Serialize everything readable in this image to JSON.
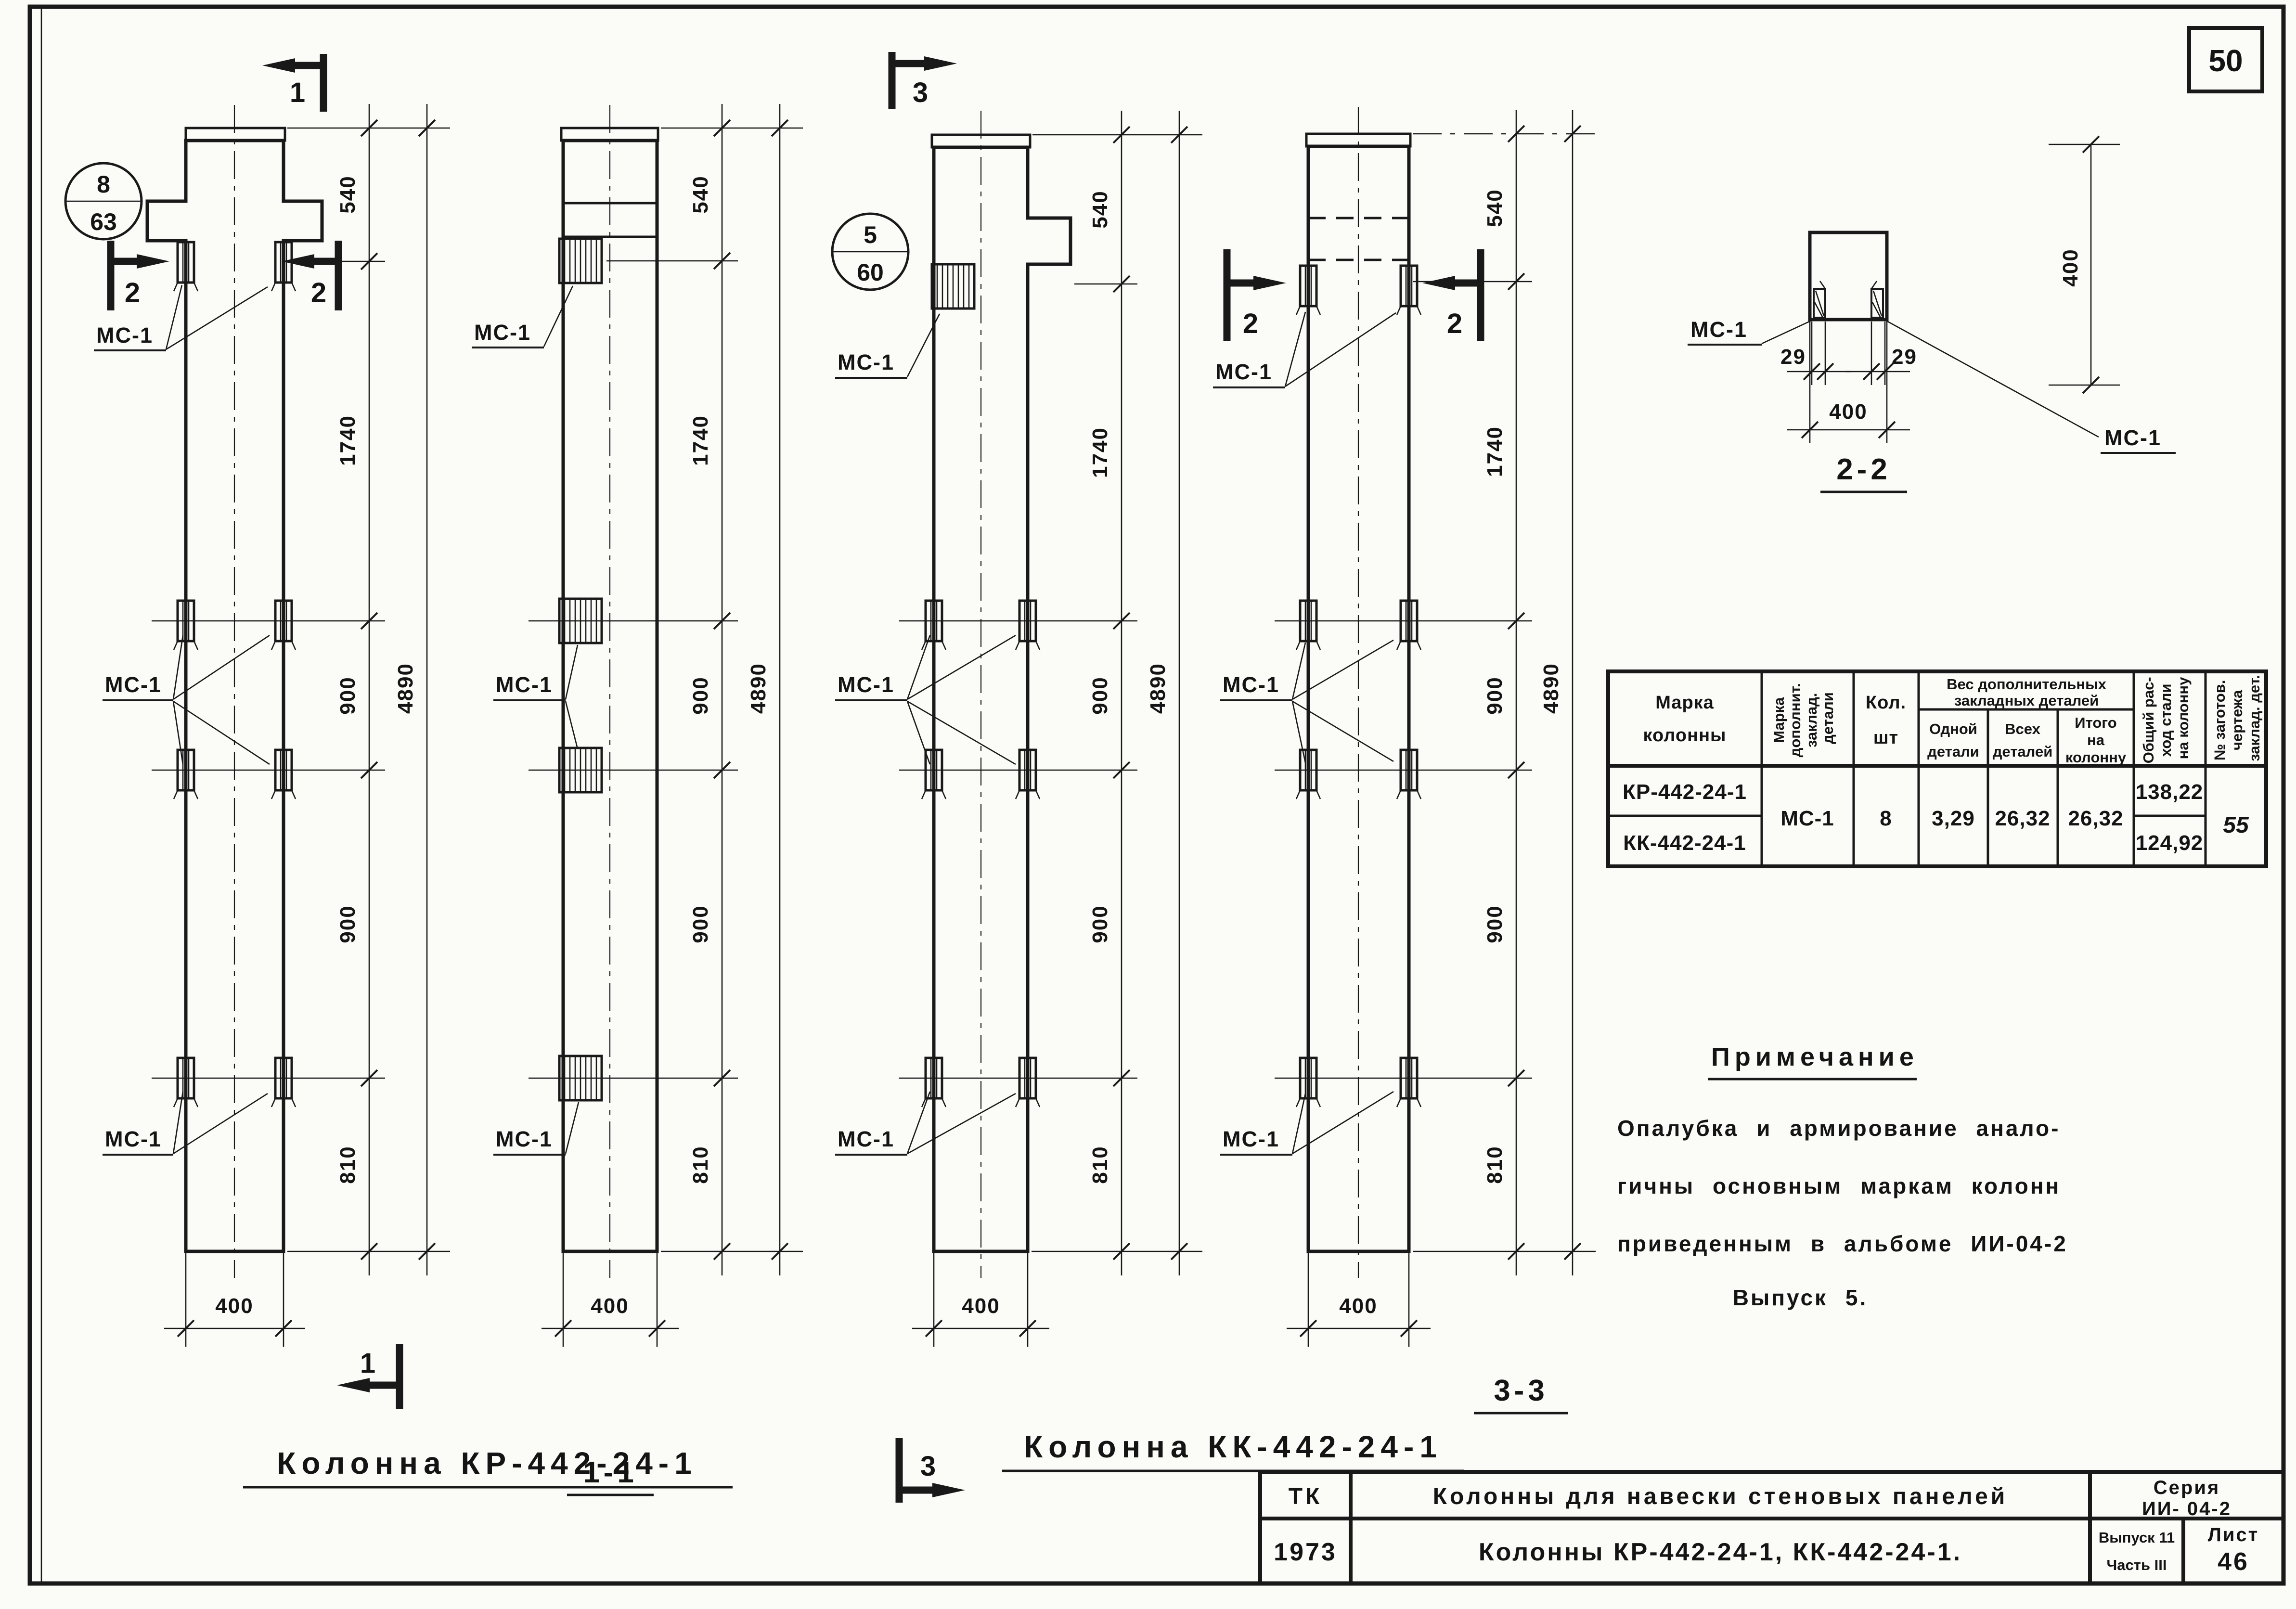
{
  "page": {
    "number": "50"
  },
  "labels": {
    "mc1": "МС-1"
  },
  "dims": {
    "seg540": "540",
    "seg1740": "1740",
    "seg900": "900",
    "seg810": "810",
    "total": "4890",
    "width": "400"
  },
  "views": {
    "kr_front": {
      "title": "Колонна  КР-442-24-1",
      "marker_top": "1",
      "marker_side_left": "2",
      "marker_side_right": "2",
      "marker_bottom": "1",
      "callout_top": "8",
      "callout_bottom": "63"
    },
    "kr_side": {
      "title": "1-1"
    },
    "kk_front": {
      "title": "Колонна  КК-442-24-1",
      "marker_top": "3",
      "marker_bottom": "3",
      "callout_top": "5",
      "callout_bottom": "60"
    },
    "kk_side": {
      "title": "3-3",
      "marker_side_left": "2",
      "marker_side_right": "2"
    }
  },
  "section": {
    "title": "2-2",
    "dim_side_left": "29",
    "dim_side_right": "29",
    "dim_width": "400",
    "dim_height": "400"
  },
  "table": {
    "headers": {
      "mark1": "Марка",
      "mark2": "колонны",
      "dop1": "Марка",
      "dop2": "дополнит.",
      "dop3": "заклад.",
      "dop4": "детали",
      "qty1": "Кол.",
      "qty2": "шт",
      "group1": "Вес дополнительных",
      "group2": "закладных деталей",
      "one1": "Одной",
      "one2": "детали",
      "all1": "Всех",
      "all2": "деталей",
      "itogo1": "Итого",
      "itogo2": "на",
      "itogo3": "колонну",
      "total1": "Общий рас-",
      "total2": "ход стали",
      "total3": "на колонну",
      "blank1": "№ заготов.",
      "blank2": "чертежа",
      "blank3": "заклад. дет."
    },
    "rows": {
      "mark_row1": "КР-442-24-1",
      "mark_row2": "КК-442-24-1",
      "dop": "МС-1",
      "qty": "8",
      "one": "3,29",
      "all": "26,32",
      "itogo": "26,32",
      "total_row1": "138,22",
      "total_row2": "124,92",
      "blank": "55"
    }
  },
  "note": {
    "title": "Примечание",
    "line1": "Опалубка  и  армирование  анало-",
    "line2": "гичны  основным  маркам  колонн",
    "line3": "приведенным  в  альбоме  ИИ-04-2",
    "line4": "Выпуск 5."
  },
  "titleblock": {
    "org": "ТК",
    "subject": "Колонны  для  навески  стеновых  панелей",
    "series1": "Серия",
    "series2": "ИИ- 04-2",
    "year": "1973",
    "content": "Колонны  КР-442-24-1, КК-442-24-1.",
    "issue1": "Выпуск 11",
    "issue2": "Часть III",
    "sheet1": "Лист",
    "sheet2": "46"
  }
}
